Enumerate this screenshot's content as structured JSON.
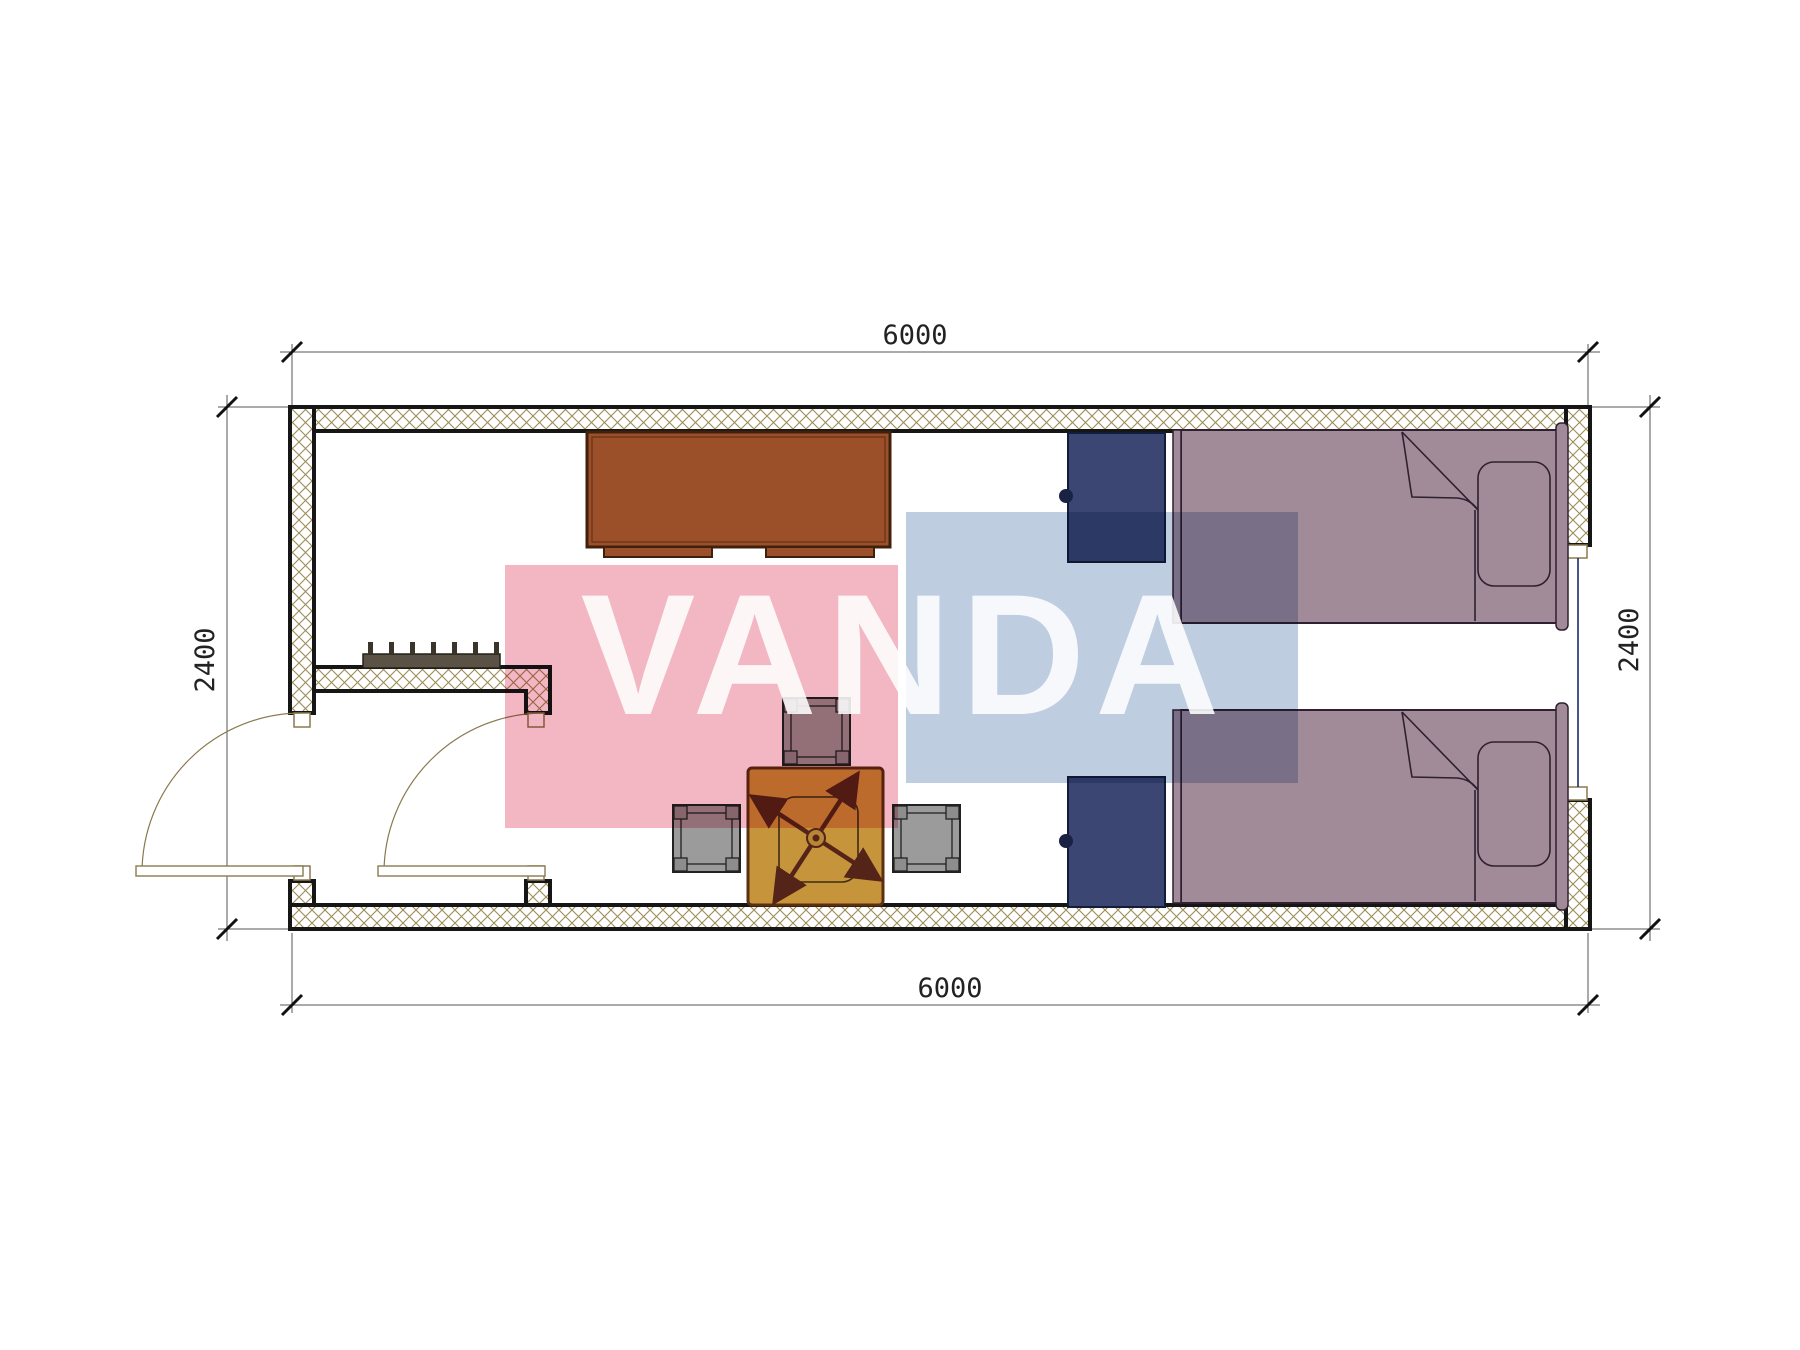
{
  "drawing": {
    "type": "floor-plan",
    "watermark": {
      "text": "VANDA",
      "pink_color": "#e87b92",
      "blue_color": "#7f9cc4"
    },
    "dimensions": {
      "top": "6000",
      "bottom": "6000",
      "left": "2400",
      "right": "2400"
    },
    "colors": {
      "wall_hatch": "#9c8c58",
      "wall_outline": "#161616",
      "jamb": "#8a7a50",
      "window_glass": "#1a2a6e",
      "desk": "#9c5029",
      "desk_outline": "#401f0c",
      "nightstand": "#3c4672",
      "nightstand_outline": "#141c3c",
      "bed": "#a18b99",
      "bed_outline": "#2e2030",
      "stool": "#9b9b9b",
      "stool_corner": "#8d8d8d",
      "table": "#c6953b",
      "table_outline": "#5c2e12",
      "fan": "#552418",
      "coat_rack": "#5a5244",
      "door_line": "#8a7a50"
    },
    "furniture_counts": {
      "beds": 2,
      "nightstands": 2,
      "stools": 3,
      "desks": 1,
      "tables": 1,
      "doors": 2,
      "windows": 1,
      "coat_racks": 1
    }
  }
}
